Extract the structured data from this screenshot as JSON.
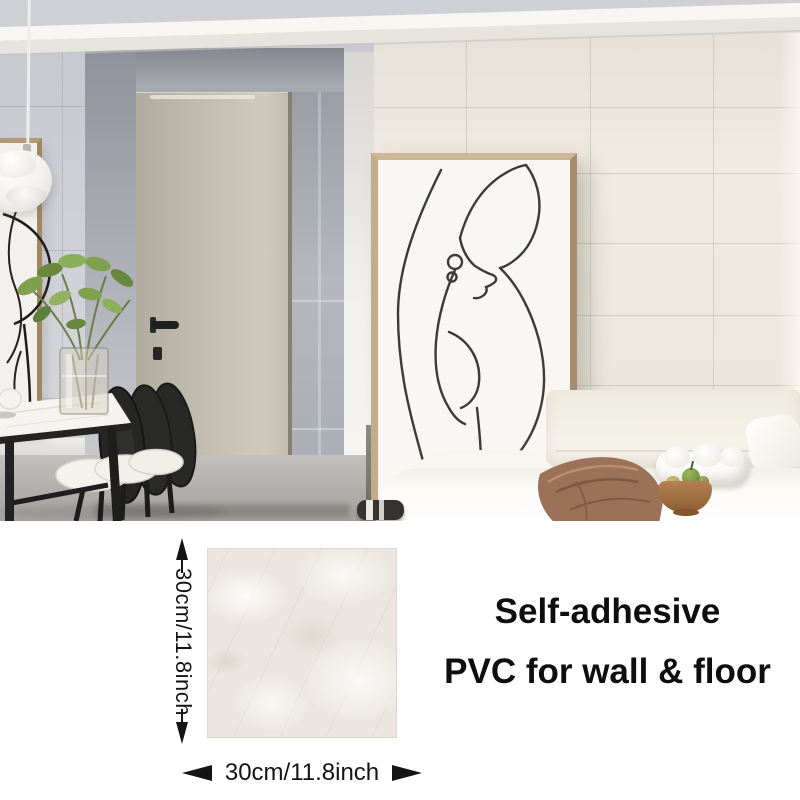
{
  "caption": {
    "line1": "Self-adhesive",
    "line2": "PVC for wall & floor"
  },
  "dimensions": {
    "vertical": "30cm/11.8inch",
    "horizontal": "30cm/11.8inch"
  },
  "colors": {
    "text": "#141414",
    "arrow": "#141414",
    "tile_base": "#ebe7e0",
    "wall_left": "#cdced4",
    "wall_right": "#ece7df",
    "door": "#c5bfb2",
    "sofa": "#f5f2ea",
    "blanket": "#9b7257",
    "wood_bowl": "#a9743f",
    "furniture_black": "#1e1e1e",
    "frame_wood": "#c4ac8b",
    "plant_green": "#7fa04f",
    "floor": "#b0aeaa"
  },
  "scene": {
    "objects": [
      "crown-molding",
      "tiled-wall",
      "interior-door",
      "door-handle",
      "glass-partition",
      "pendant-lamp",
      "wall-art-left",
      "wall-art-line-drawing-woman",
      "dining-table",
      "dining-chairs",
      "potted-plant",
      "glass-vase",
      "teapot",
      "sofa",
      "throw-pillow",
      "scrunched-pillow",
      "throw-blanket",
      "wooden-fruit-bowl",
      "striped-speaker",
      "floor-lamp"
    ]
  }
}
